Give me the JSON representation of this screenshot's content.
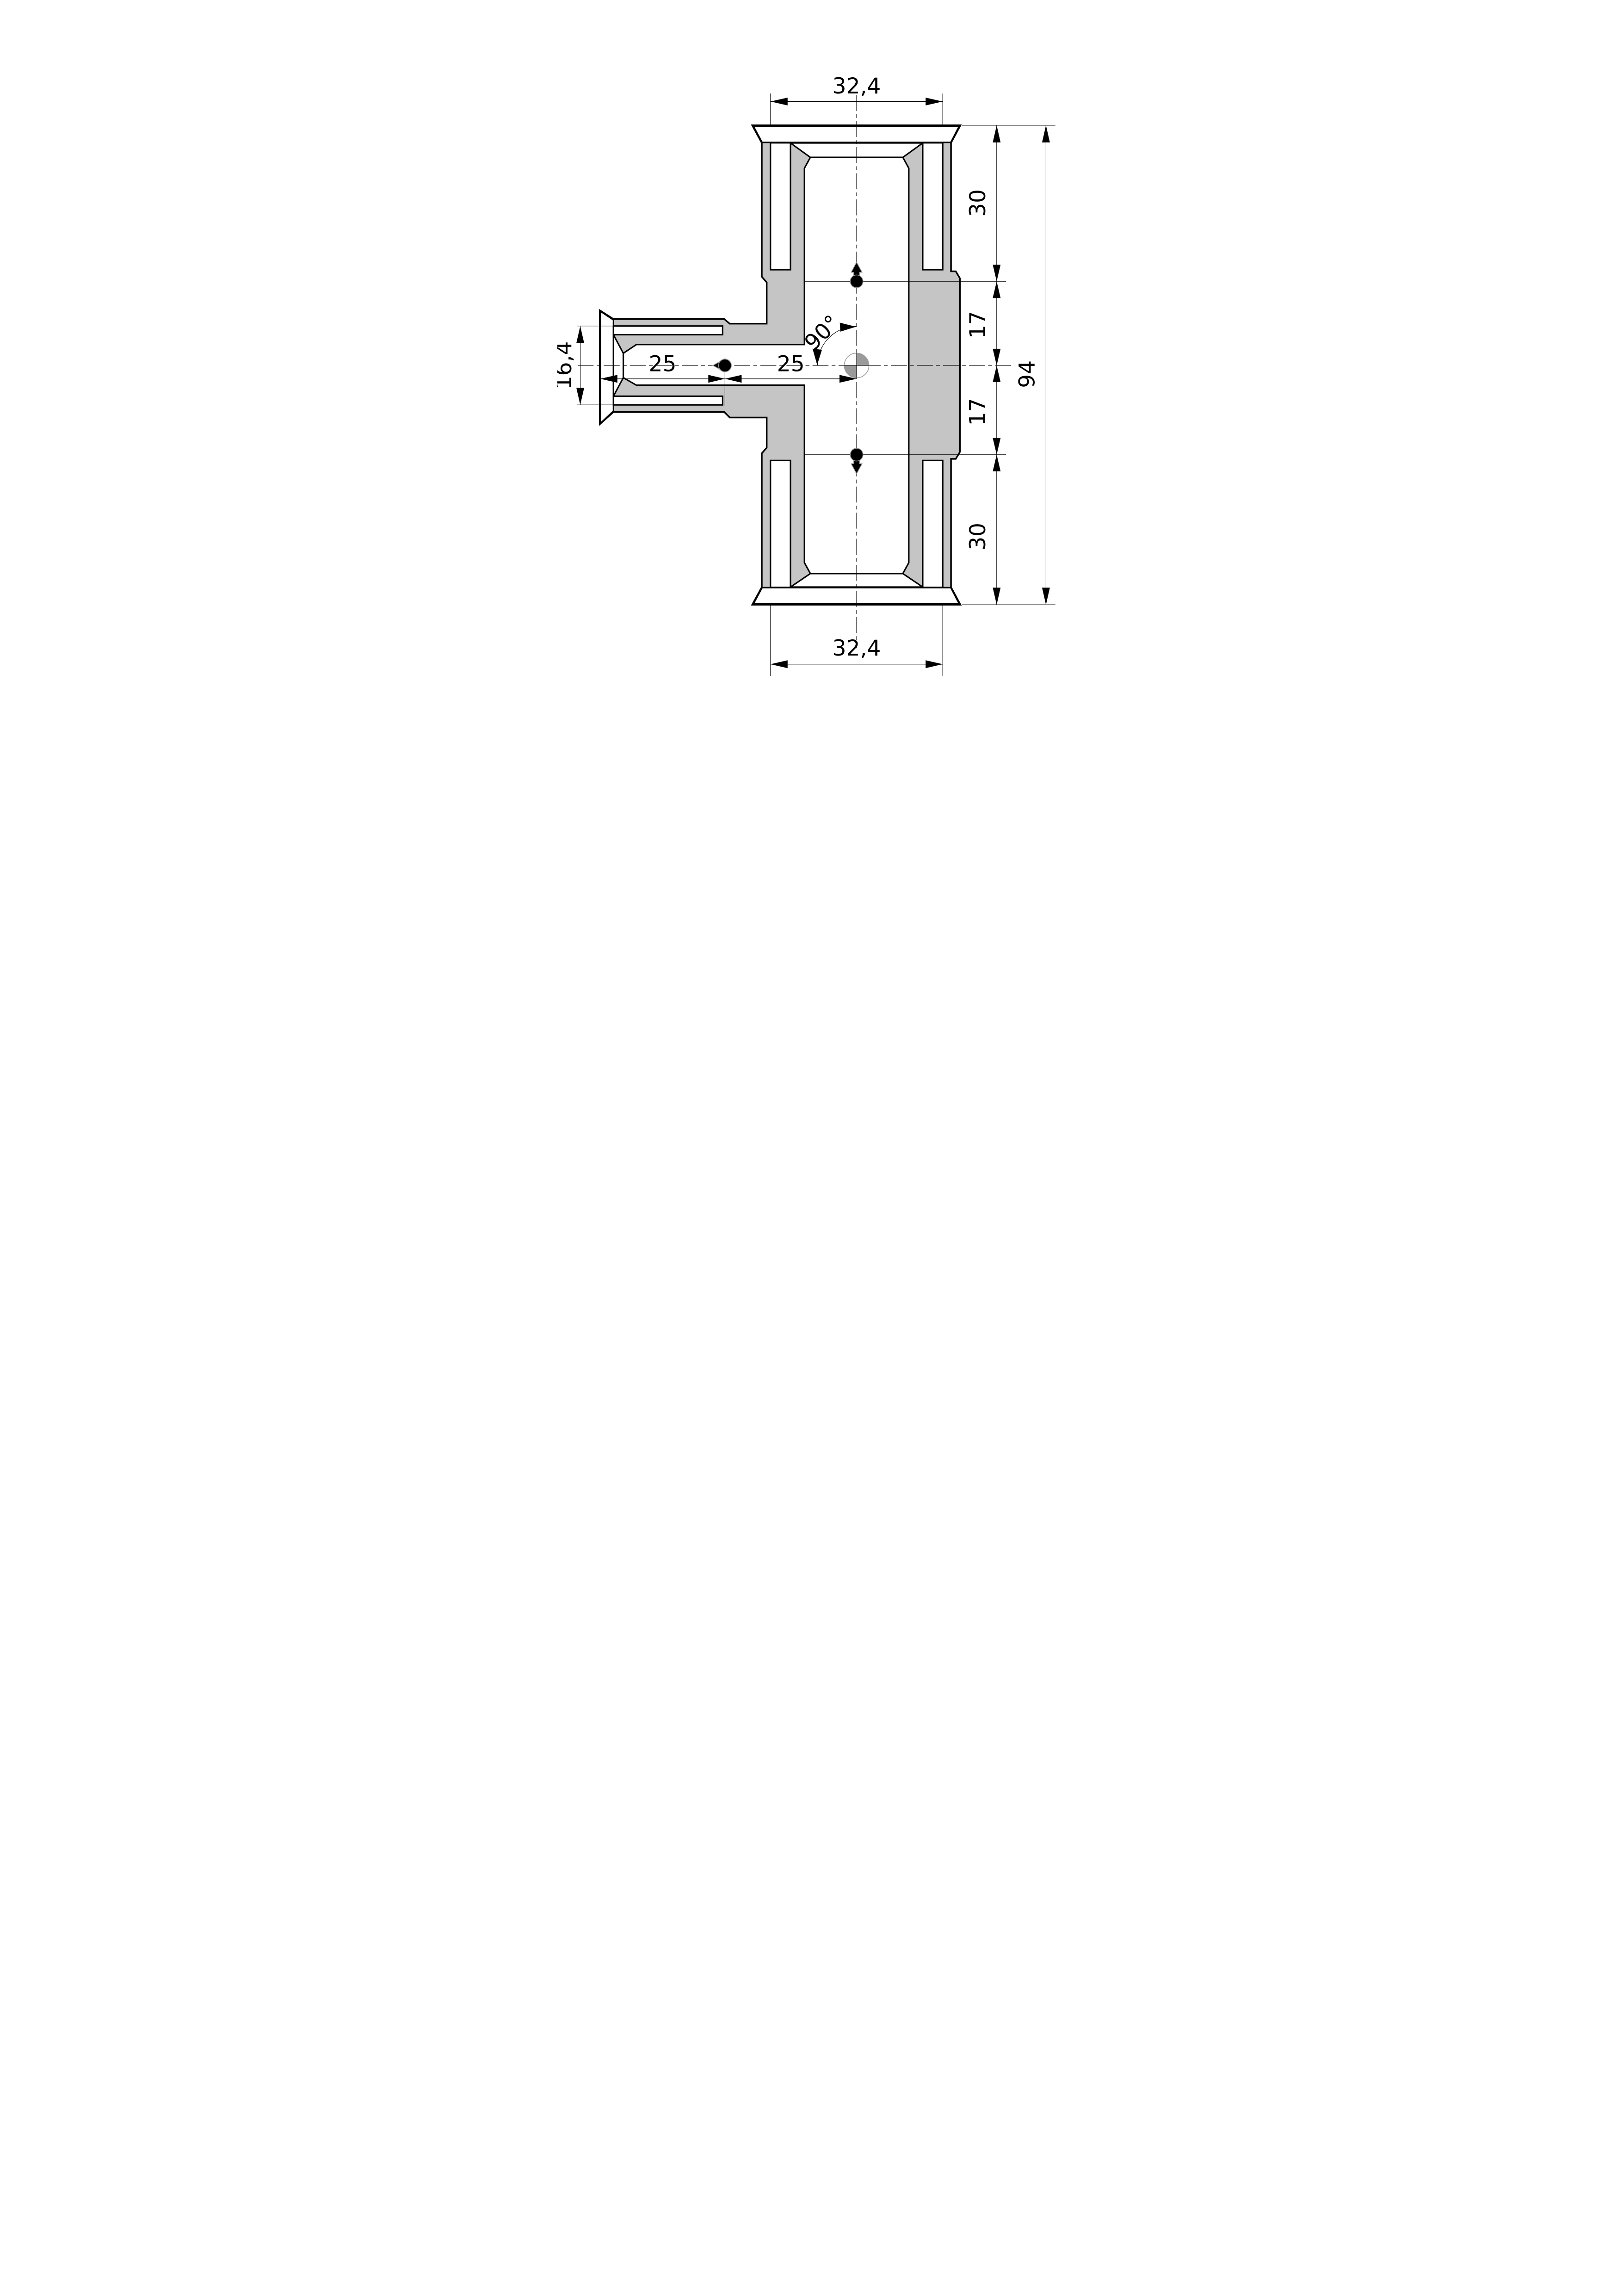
{
  "drawing": {
    "title": "tee-fitting-cross-section",
    "type": "technical-dimension-drawing",
    "dimensions": {
      "top_width": "32,4",
      "bottom_width": "32,4",
      "overall_height": "94",
      "right_chain": [
        "30",
        "17",
        "17",
        "30"
      ],
      "branch_socket_diameter": "16,4",
      "insertion_depth_left": "25",
      "insertion_depth_right": "25",
      "branch_angle": "90°"
    },
    "colors": {
      "material_fill": "#c5c5c5",
      "line": "#000000",
      "symbol_gray": "#9a9a9a",
      "background": "#ffffff"
    },
    "symbols": {
      "centroid": "center-of-axes quadrant circle",
      "flow_markers": [
        "up",
        "down",
        "left"
      ]
    }
  }
}
